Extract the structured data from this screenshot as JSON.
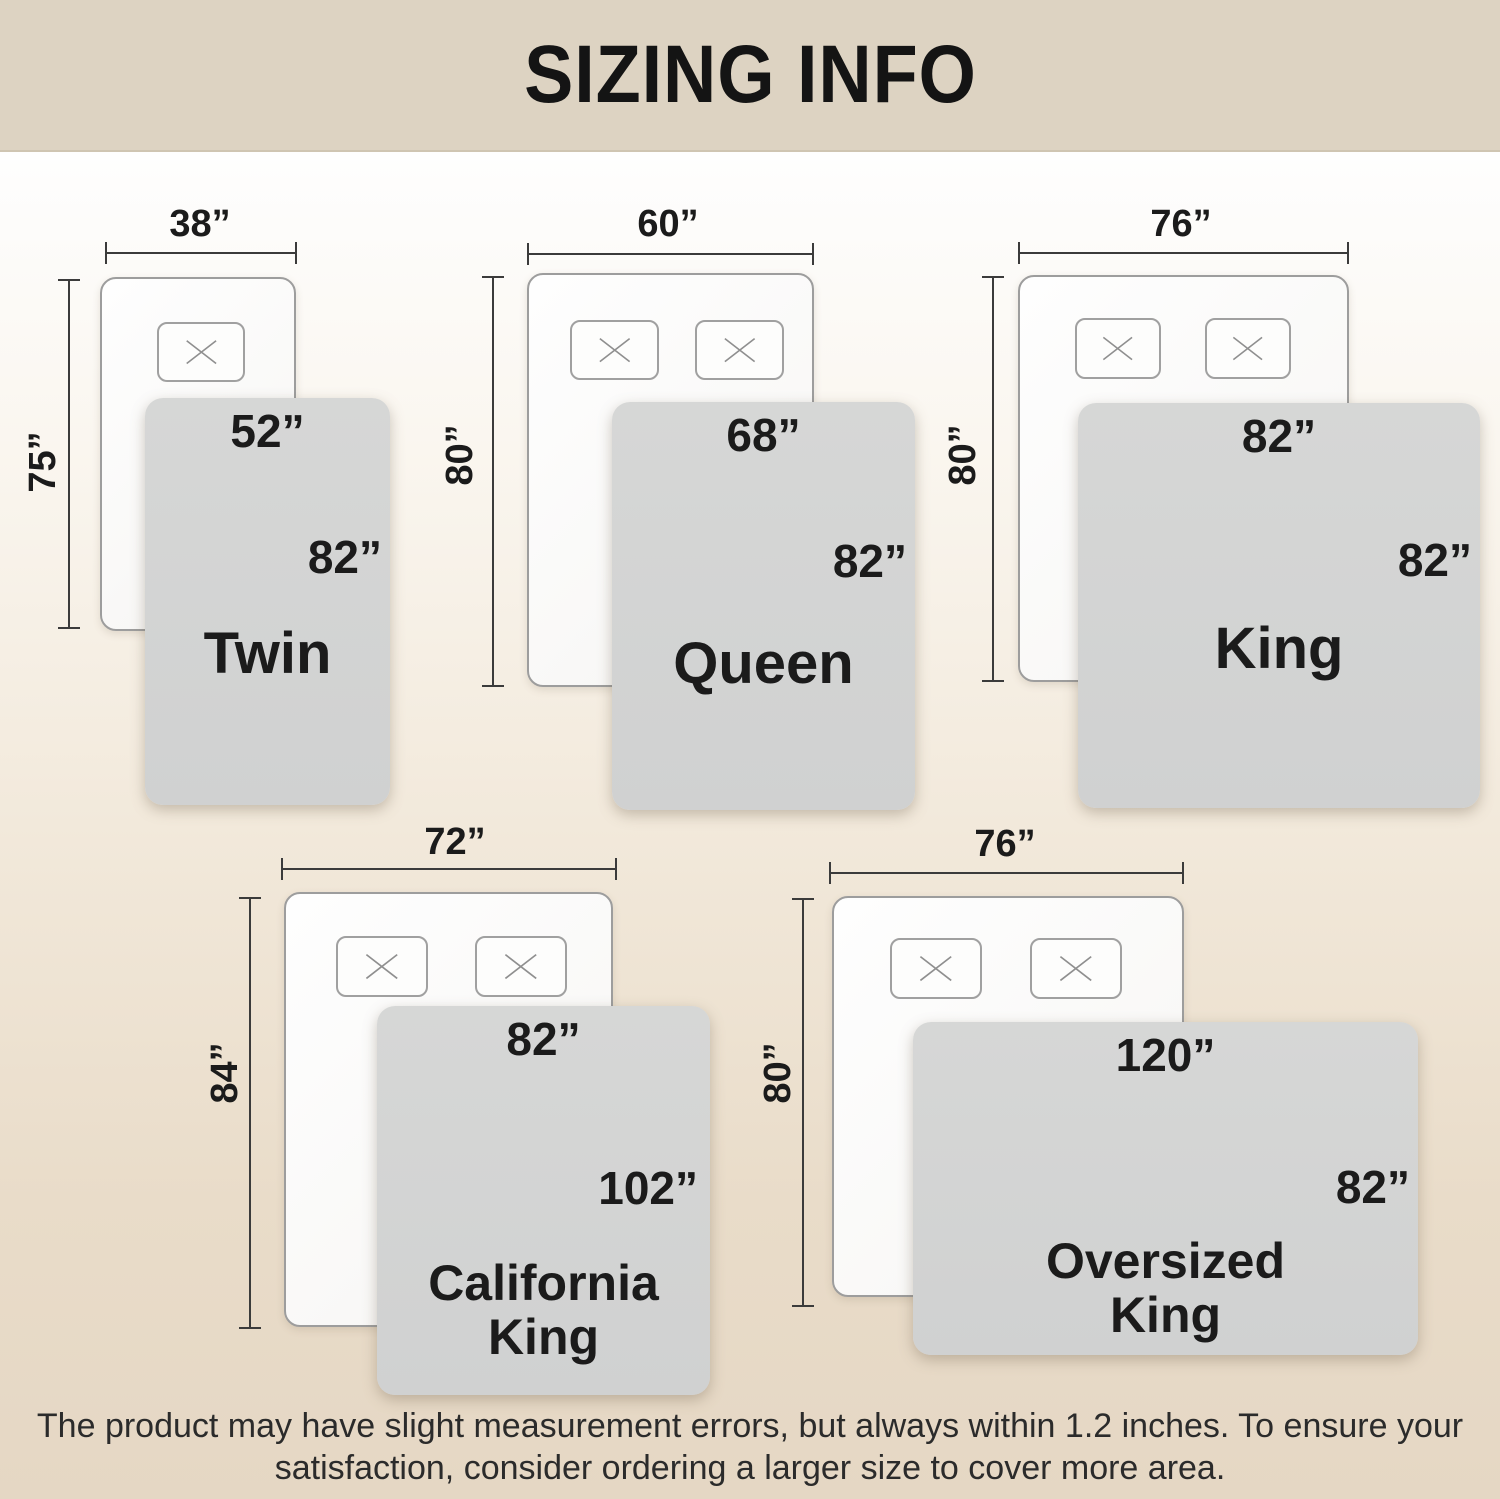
{
  "title": "SIZING INFO",
  "beds": [
    {
      "name": "Twin",
      "mattress_width": "38”",
      "mattress_height": "75”",
      "blanket_width": "52”",
      "blanket_height": "82”",
      "pillow_count": 1
    },
    {
      "name": "Queen",
      "mattress_width": "60”",
      "mattress_height": "80”",
      "blanket_width": "68”",
      "blanket_height": "82”",
      "pillow_count": 2
    },
    {
      "name": "King",
      "mattress_width": "76”",
      "mattress_height": "80”",
      "blanket_width": "82”",
      "blanket_height": "82”",
      "pillow_count": 2
    },
    {
      "name": "California King",
      "mattress_width": "72”",
      "mattress_height": "84”",
      "blanket_width": "82”",
      "blanket_height": "102”",
      "pillow_count": 2
    },
    {
      "name": "Oversized King",
      "mattress_width": "76”",
      "mattress_height": "80”",
      "blanket_width": "120”",
      "blanket_height": "82”",
      "pillow_count": 2
    }
  ],
  "footer": {
    "line1": "The product may have slight measurement errors, but always within 1.2 inches. To ensure your",
    "line2": "satisfaction, consider ordering a larger size to cover more area."
  },
  "colors": {
    "header_bg": "#ddd3c2",
    "page_bg_bottom": "#e5d7c4",
    "blanket": "#d3d4d3",
    "mattress": "#fbfbfa",
    "outline": "#9d9d9d",
    "dimension_line": "#3b3b3b",
    "text": "#1b1b1b"
  }
}
